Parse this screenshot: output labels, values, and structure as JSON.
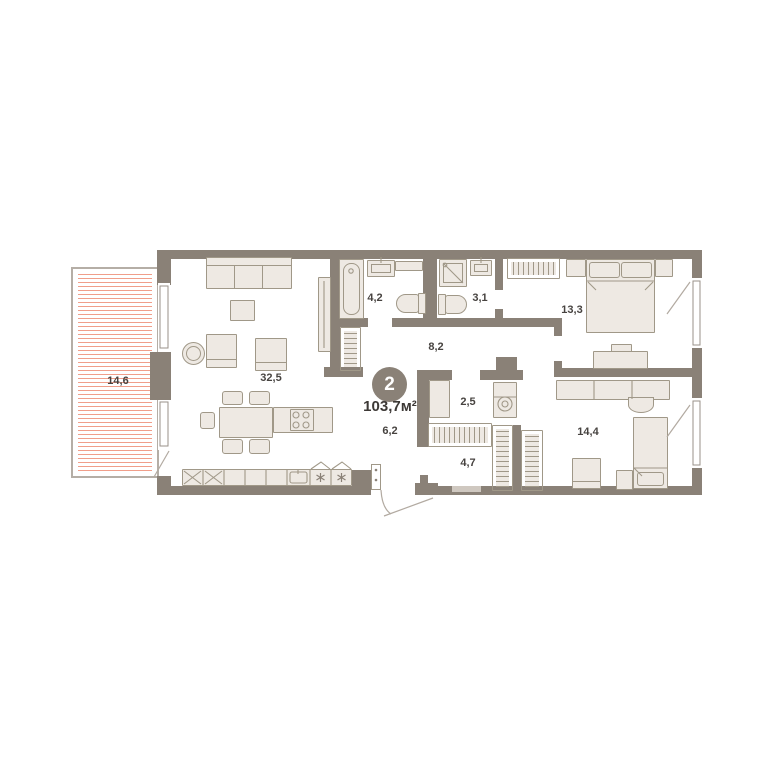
{
  "floor_plan": {
    "badge": {
      "rooms_count": "2",
      "total_area": "103,7м²"
    },
    "room_labels": {
      "balcony": "14,6",
      "living_kitchen": "32,5",
      "bathroom": "4,2",
      "shower_room": "3,1",
      "hall": "8,2",
      "bedroom_1": "13,3",
      "wardrobe_room": "2,5",
      "corridor": "6,2",
      "entry_hall": "4,7",
      "bedroom_2": "14,4"
    },
    "colors": {
      "wall": "#8a8177",
      "furniture_border": "#a09888",
      "furniture_fill": "#eee9e3",
      "balcony_hatch": "#f09e8a",
      "text": "#474340",
      "badge_bg": "#8a8177"
    }
  }
}
